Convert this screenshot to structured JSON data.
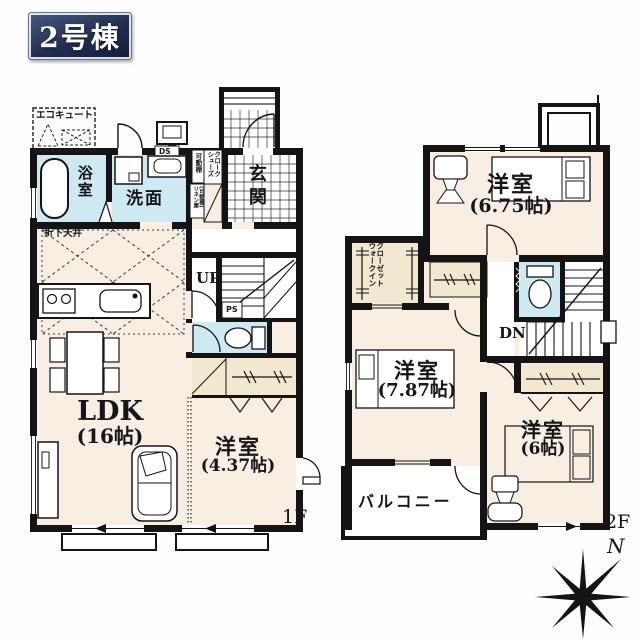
{
  "badge": {
    "label": "2号棟"
  },
  "floor1": {
    "label": "1F",
    "ecocute": "エコキュート",
    "bath": "浴室",
    "wash": "洗面",
    "ds": "DS",
    "movable_shelf": "可動棚",
    "shoes_closet_line1": "シューズ",
    "shoes_closet_line2": "クローク",
    "linen_line1": "リネン庫",
    "linen_line2": "(可動棚)",
    "entrance": "玄関",
    "dropped_ceiling": "折下天井",
    "stairs_up": "UP",
    "pipe_space": "PS",
    "ldk_name": "LDK",
    "ldk_size": "(16帖)",
    "bedroom_name": "洋室",
    "bedroom_size": "(4.37帖)"
  },
  "floor2": {
    "label": "2F",
    "bedroom675_name": "洋室",
    "bedroom675_size": "(6.75帖)",
    "wic_line1": "ウォークイン",
    "wic_line2": "クローゼット",
    "stairs_down": "DN",
    "bedroom787_name": "洋室",
    "bedroom787_size": "(7.87帖)",
    "bedroom6_name": "洋室",
    "bedroom6_size": "(6帖)",
    "balcony": "バルコニー"
  },
  "compass": {
    "north": "N"
  },
  "colors": {
    "wall": "#141414",
    "room_floor": "#f8efe2",
    "wet_floor": "#cde9f2",
    "closet_floor": "#f2e7cf",
    "badge_bg": "#202e52",
    "badge_text": "#ffffff"
  }
}
